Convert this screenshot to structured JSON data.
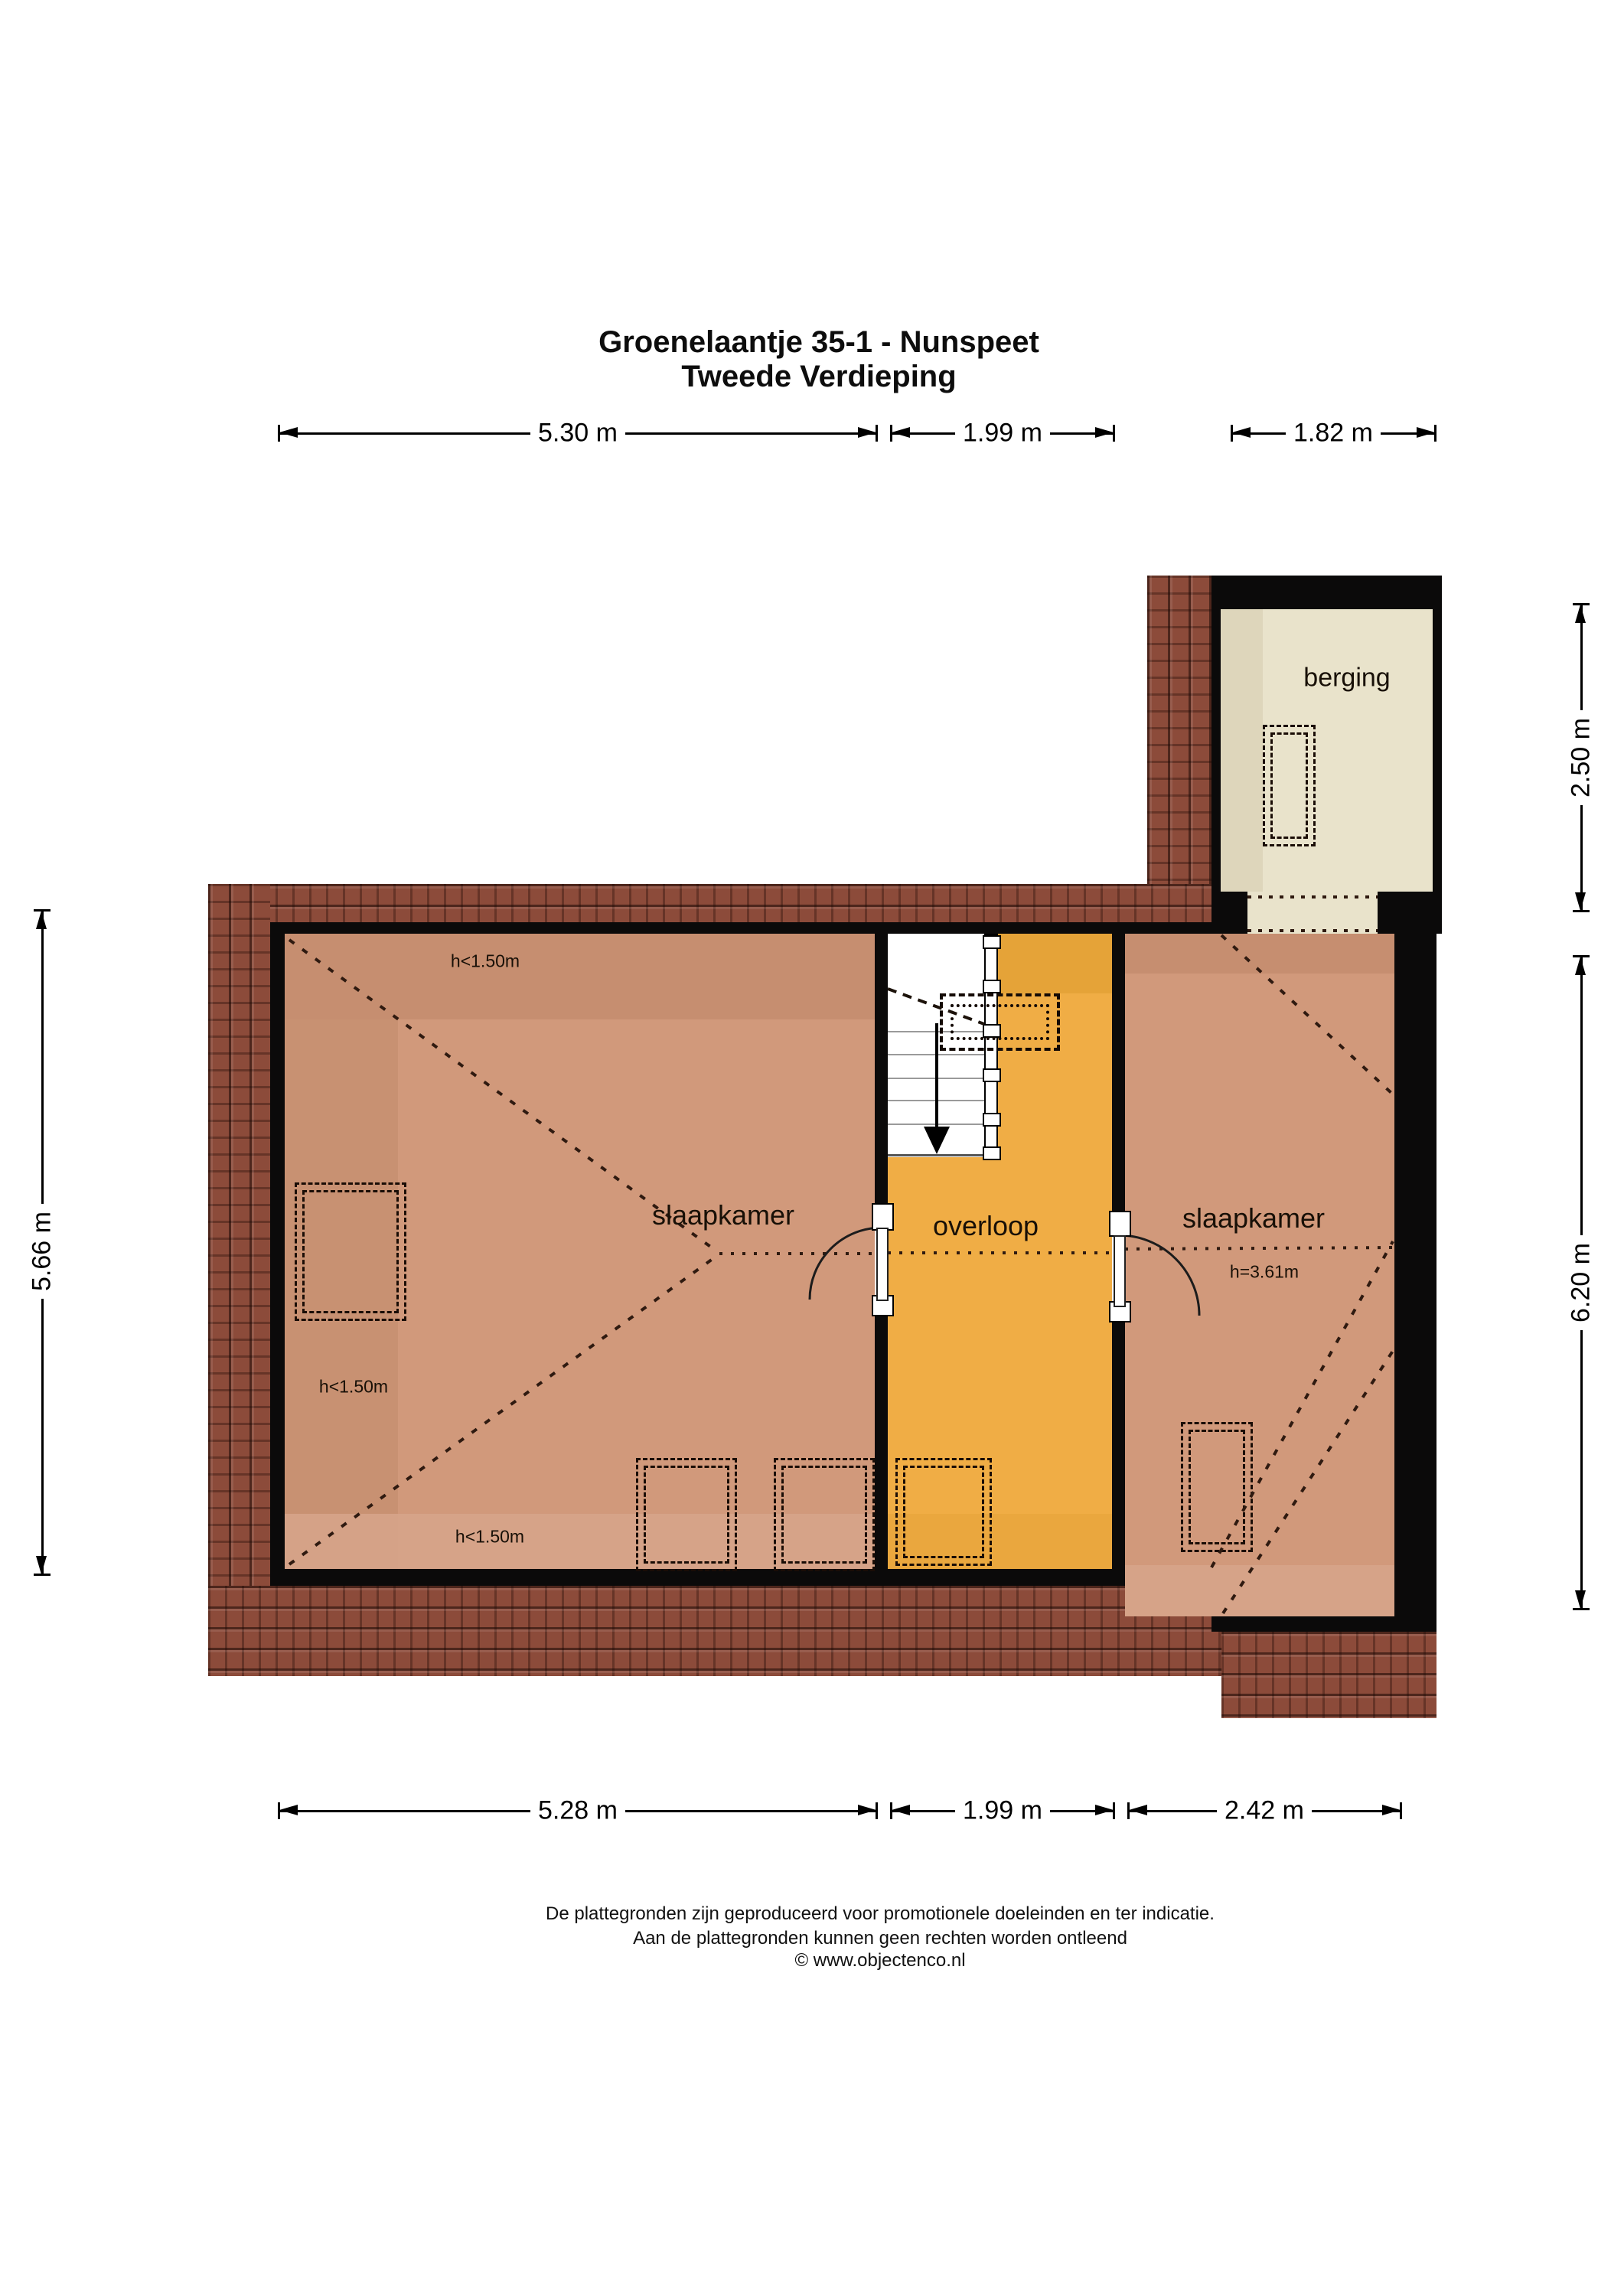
{
  "title": {
    "line1": "Groenelaantje 35-1 - Nunspeet",
    "line2": "Tweede Verdieping"
  },
  "dims": {
    "top": [
      {
        "label": "5.30 m"
      },
      {
        "label": "1.99 m"
      },
      {
        "label": "1.82 m"
      }
    ],
    "bottom": [
      {
        "label": "5.28 m"
      },
      {
        "label": "1.99 m"
      },
      {
        "label": "2.42 m"
      }
    ],
    "left": [
      {
        "label": "5.66 m"
      }
    ],
    "right": [
      {
        "label": "2.50 m"
      },
      {
        "label": "6.20 m"
      }
    ]
  },
  "rooms": {
    "bedroom_left": {
      "label": "slaapkamer"
    },
    "landing": {
      "label": "overloop"
    },
    "bedroom_right": {
      "label": "slaapkamer"
    },
    "storage": {
      "label": "berging"
    }
  },
  "heights": {
    "left_top": {
      "text": "h<1.50m"
    },
    "left_mid": {
      "text": "h<1.50m"
    },
    "left_bottom": {
      "text": "h<1.50m"
    },
    "right": {
      "text": "h=3.61m"
    }
  },
  "icons": {
    "stairs_direction": "down-arrow-icon"
  },
  "footer": {
    "line1": "De plattegronden zijn geproduceerd voor promotionele doeleinden en ter indicatie.",
    "line2": "Aan de plattegronden kunnen geen rechten worden ontleend",
    "line3": "© www.objectenco.nl"
  },
  "colors": {
    "wall": "#0b0a0a",
    "tile": "#8c4b3a",
    "room": "#d1997b",
    "room-dk": "#c68e70",
    "room-lt": "#d7a58b",
    "ol": "#f0ad45",
    "ol-dk": "#e5a338",
    "berg": "#e9e3cb",
    "berg-dk": "#ded6bb",
    "ink": "#2f1a10"
  }
}
